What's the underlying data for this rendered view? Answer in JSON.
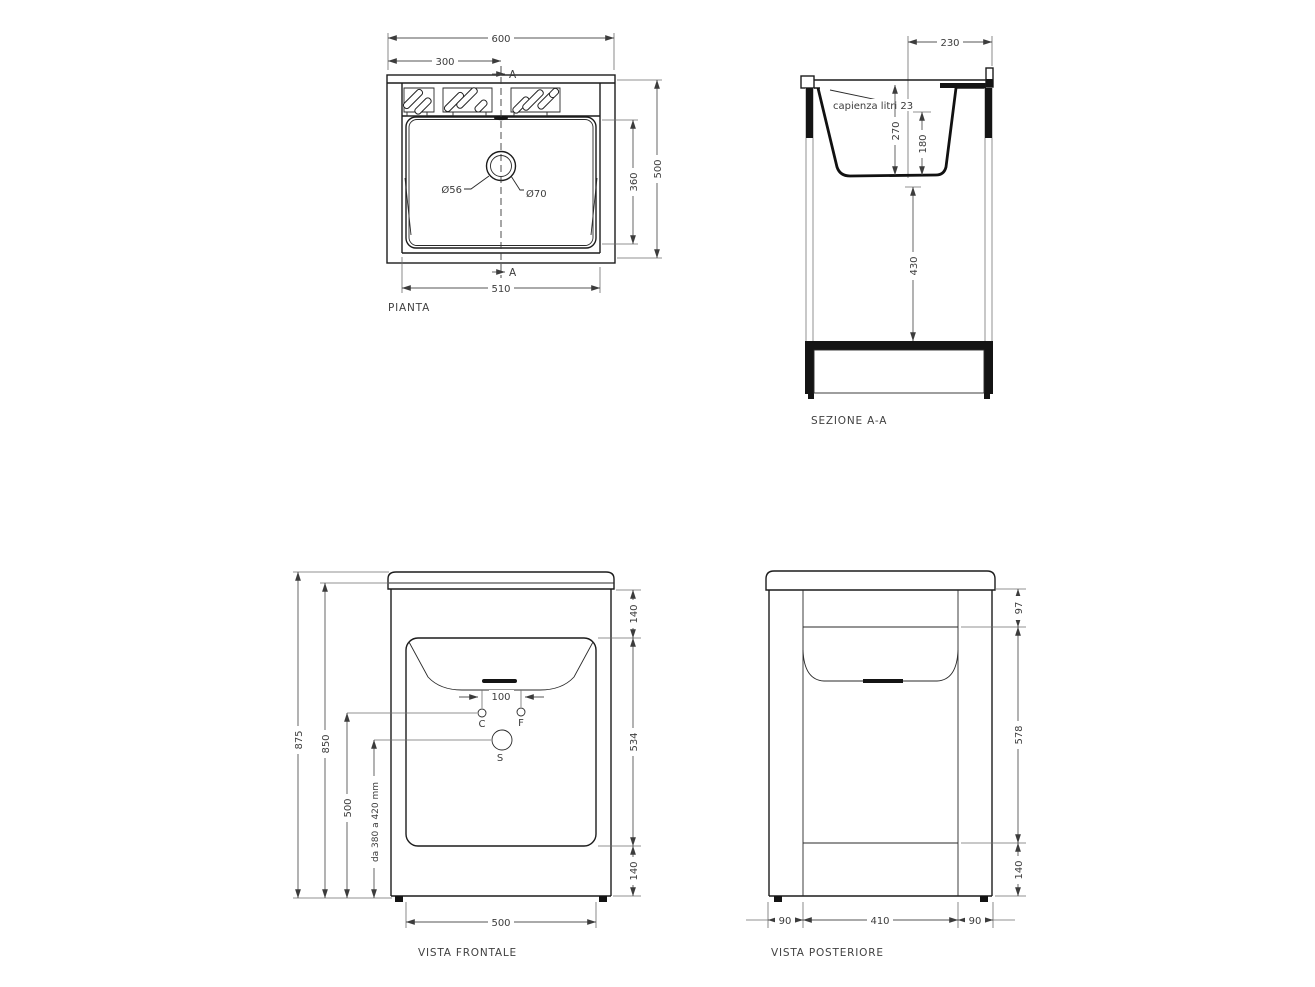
{
  "views": {
    "pianta": {
      "title": "PIANTA",
      "section_marker_top": "A",
      "section_marker_bottom": "A",
      "dim_width_total": "600",
      "dim_width_to_center": "300",
      "dim_depth_total": "500",
      "dim_basin_depth": "360",
      "dim_width_bottom": "510",
      "drain_small": "Ø56",
      "drain_large": "Ø70"
    },
    "sezione": {
      "title": "SEZIONE A-A",
      "capacity_note": "capienza litri 23",
      "dim_top_depth": "230",
      "dim_basin_depth": "270",
      "dim_basin_inner_depth": "180",
      "dim_under_basin": "430"
    },
    "frontale": {
      "title": "VISTA FRONTALE",
      "dim_height_total": "875",
      "dim_height_body": "850",
      "dim_height_taps": "500",
      "dim_height_drain_range": "da 380 a 420 mm",
      "dim_top_band": "140",
      "dim_middle_band": "534",
      "dim_bottom_band": "140",
      "dim_tap_spacing": "100",
      "dim_width_bottom": "500",
      "label_c": "C",
      "label_f": "F",
      "label_s": "S"
    },
    "posteriore": {
      "title": "VISTA POSTERIORE",
      "dim_top_band": "97",
      "dim_middle_band": "578",
      "dim_bottom_band": "140",
      "dim_left_margin": "90",
      "dim_center_width": "410",
      "dim_right_margin": "90"
    }
  }
}
